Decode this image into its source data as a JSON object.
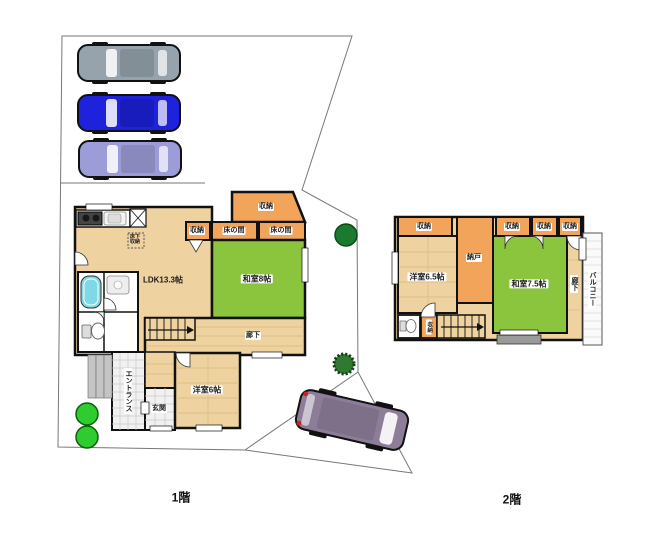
{
  "colors": {
    "wall": "#1a1a1a",
    "floor_wood": "#eed2a0",
    "floor_line": "#d9b97e",
    "tatami": "#8bc53e",
    "storage": "#f2a45b",
    "tile": "#f1f1f1",
    "tile_line": "#c9c9c9",
    "steps_gray": "#c4c4c4",
    "tub": "#7fd8e6",
    "car_gray": "#96a3ac",
    "car_blue": "#1e22dd",
    "car_lavender": "#9c9cd8",
    "van": "#8d7d99",
    "tree_bright": "#2ecc2e",
    "tree_dark": "#1c7a30",
    "tree_spiky": "#2f7a33",
    "boundary": "#777777",
    "balcony_fill": "#fafafa",
    "gray_box": "#9a9a9a"
  },
  "f1": {
    "caption": "1階",
    "ldk": "LDK13.3帖",
    "washitsu": "和室8帖",
    "yoshitsu": "洋室6帖",
    "hallway": "廊下",
    "entrance": "エントランス",
    "genkan": "玄関",
    "storage_top": "収納",
    "storage_row": "収納",
    "tokonoma_left": "床の間",
    "tokonoma_right": "床の間",
    "underfloor": "床下収納"
  },
  "f2": {
    "caption": "2階",
    "yoshitsu": "洋室6.5帖",
    "washitsu": "和室7.5帖",
    "nando": "納戸",
    "hallway": "廊下",
    "balcony": "バルコニー",
    "storage_top_left": "収納",
    "storage_a": "収納",
    "storage_b": "収納",
    "storage_c": "収納",
    "storage_small": "収納"
  }
}
